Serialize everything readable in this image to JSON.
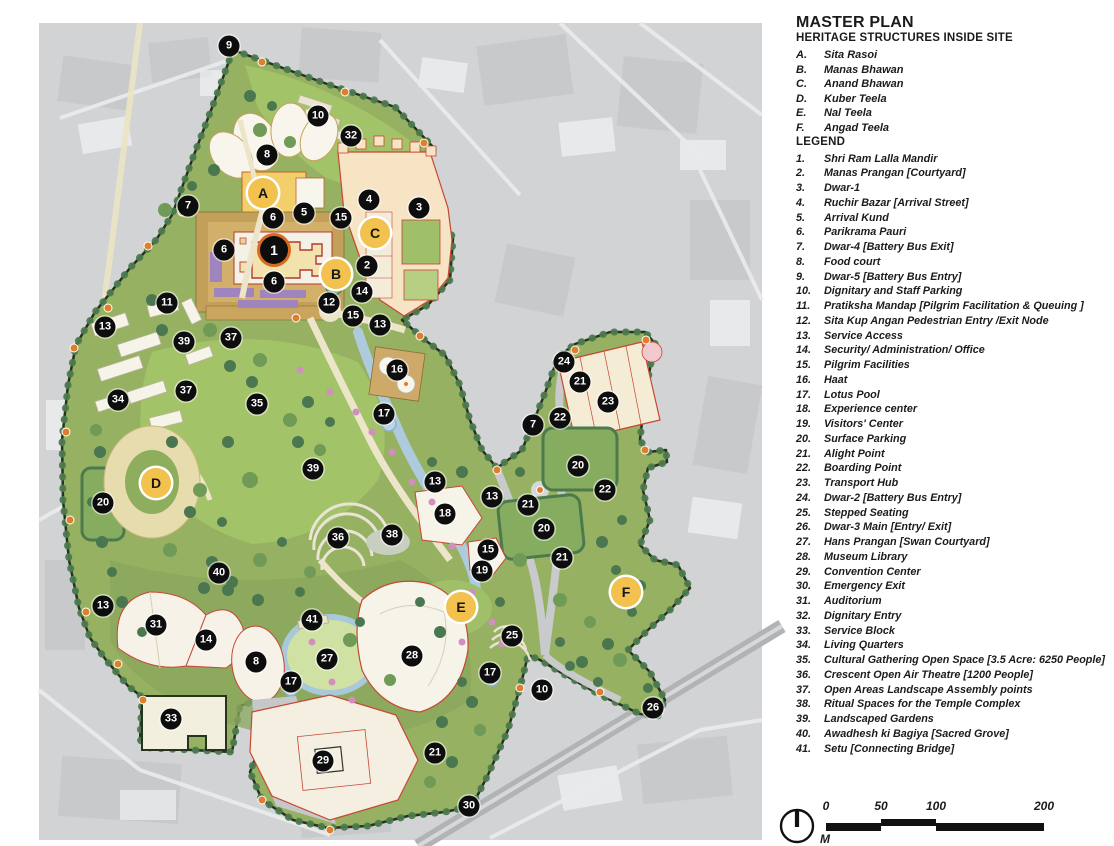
{
  "panel": {
    "title": "MASTER PLAN",
    "heritage": {
      "heading": "HERITAGE STRUCTURES INSIDE SITE",
      "items": [
        {
          "num": "A.",
          "label": "Sita Rasoi"
        },
        {
          "num": "B.",
          "label": "Manas Bhawan"
        },
        {
          "num": "C.",
          "label": "Anand Bhawan"
        },
        {
          "num": "D.",
          "label": "Kuber Teela"
        },
        {
          "num": "E.",
          "label": "Nal Teela"
        },
        {
          "num": "F.",
          "label": "Angad Teela"
        }
      ]
    },
    "legend": {
      "heading": "LEGEND",
      "items": [
        {
          "num": "1.",
          "label": "Shri Ram Lalla Mandir"
        },
        {
          "num": "2.",
          "label": "Manas Prangan [Courtyard]"
        },
        {
          "num": "3.",
          "label": "Dwar-1"
        },
        {
          "num": "4.",
          "label": "Ruchir Bazar [Arrival Street]"
        },
        {
          "num": "5.",
          "label": "Arrival Kund"
        },
        {
          "num": "6.",
          "label": "Parikrama Pauri"
        },
        {
          "num": "7.",
          "label": "Dwar-4 [Battery Bus Exit]"
        },
        {
          "num": "8.",
          "label": "Food court"
        },
        {
          "num": "9.",
          "label": "Dwar-5 [Battery Bus Entry]"
        },
        {
          "num": "10.",
          "label": "Dignitary and Staff Parking"
        },
        {
          "num": "11.",
          "label": "Pratiksha Mandap [Pilgrim Facilitation & Queuing ]"
        },
        {
          "num": "12.",
          "label": "Sita Kup Angan Pedestrian Entry /Exit Node"
        },
        {
          "num": "13.",
          "label": "Service Access"
        },
        {
          "num": "14.",
          "label": "Security/ Administration/ Office"
        },
        {
          "num": "15.",
          "label": "Pilgrim Facilities"
        },
        {
          "num": "16.",
          "label": "Haat"
        },
        {
          "num": "17.",
          "label": "Lotus Pool"
        },
        {
          "num": "18.",
          "label": "Experience center"
        },
        {
          "num": "19.",
          "label": "Visitors' Center"
        },
        {
          "num": "20.",
          "label": "Surface Parking"
        },
        {
          "num": "21.",
          "label": "Alight Point"
        },
        {
          "num": "22.",
          "label": "Boarding Point"
        },
        {
          "num": "23.",
          "label": "Transport Hub"
        },
        {
          "num": "24.",
          "label": "Dwar-2 [Battery Bus Entry]"
        },
        {
          "num": "25.",
          "label": "Stepped Seating"
        },
        {
          "num": "26.",
          "label": "Dwar-3 Main [Entry/ Exit]"
        },
        {
          "num": "27.",
          "label": "Hans Prangan [Swan Courtyard]"
        },
        {
          "num": "28.",
          "label": "Museum Library"
        },
        {
          "num": "29.",
          "label": "Convention Center"
        },
        {
          "num": "30.",
          "label": "Emergency Exit"
        },
        {
          "num": "31.",
          "label": "Auditorium"
        },
        {
          "num": "32.",
          "label": "Dignitary Entry"
        },
        {
          "num": "33.",
          "label": "Service Block"
        },
        {
          "num": "34.",
          "label": "Living Quarters"
        },
        {
          "num": "35.",
          "label": "Cultural Gathering Open Space [3.5 Acre: 6250 People]"
        },
        {
          "num": "36.",
          "label": "Crescent Open Air Theatre [1200 People]"
        },
        {
          "num": "37.",
          "label": "Open Areas Landscape Assembly points"
        },
        {
          "num": "38.",
          "label": "Ritual Spaces for the Temple Complex"
        },
        {
          "num": "39.",
          "label": "Landscaped Gardens"
        },
        {
          "num": "40.",
          "label": "Awadhesh ki Bagiya [Sacred Grove]"
        },
        {
          "num": "41.",
          "label": "Setu [Connecting Bridge]"
        }
      ]
    },
    "scale": {
      "ticks": [
        {
          "label": "0",
          "x": 0
        },
        {
          "label": "50",
          "x": 55
        },
        {
          "label": "100",
          "x": 110
        },
        {
          "label": "200",
          "x": 218
        }
      ],
      "unit": "M",
      "north_icon": "compass-north-arrow"
    }
  },
  "map": {
    "colors": {
      "marker_number_bg": "#0d0d0d",
      "marker_number_text": "#ffffff",
      "marker_letter_bg": "#f2c14e",
      "marker_letter_text": "#161616",
      "marker_1_ring": "#d86a1f",
      "site_green": "#96b161",
      "lawn_green": "#a3c368",
      "temple_tan": "#c9a55e",
      "building_cream": "#f6f2e7",
      "building_outline_red": "#c74634",
      "water_blue": "#aecbdd",
      "aerial_gray": "#d2d3d5",
      "entry_node_orange": "#df7e2b"
    },
    "markers": [
      {
        "label": "9",
        "x": 229,
        "y": 46
      },
      {
        "label": "10",
        "x": 318,
        "y": 116
      },
      {
        "label": "32",
        "x": 351,
        "y": 136
      },
      {
        "label": "8",
        "x": 267,
        "y": 155
      },
      {
        "label": "A",
        "x": 263,
        "y": 193,
        "kind": "letter"
      },
      {
        "label": "7",
        "x": 188,
        "y": 206
      },
      {
        "label": "4",
        "x": 369,
        "y": 200
      },
      {
        "label": "3",
        "x": 419,
        "y": 208
      },
      {
        "label": "5",
        "x": 304,
        "y": 213
      },
      {
        "label": "6",
        "x": 273,
        "y": 218
      },
      {
        "label": "15",
        "x": 341,
        "y": 218
      },
      {
        "label": "C",
        "x": 375,
        "y": 233,
        "kind": "letter"
      },
      {
        "label": "1",
        "x": 274,
        "y": 250,
        "big": true
      },
      {
        "label": "6",
        "x": 224,
        "y": 250
      },
      {
        "label": "2",
        "x": 367,
        "y": 266
      },
      {
        "label": "B",
        "x": 336,
        "y": 274,
        "kind": "letter"
      },
      {
        "label": "6",
        "x": 274,
        "y": 282
      },
      {
        "label": "14",
        "x": 362,
        "y": 292
      },
      {
        "label": "12",
        "x": 329,
        "y": 303
      },
      {
        "label": "11",
        "x": 167,
        "y": 303
      },
      {
        "label": "15",
        "x": 353,
        "y": 316
      },
      {
        "label": "13",
        "x": 380,
        "y": 325
      },
      {
        "label": "13",
        "x": 105,
        "y": 327
      },
      {
        "label": "37",
        "x": 231,
        "y": 338
      },
      {
        "label": "39",
        "x": 184,
        "y": 342
      },
      {
        "label": "24",
        "x": 564,
        "y": 362
      },
      {
        "label": "16",
        "x": 397,
        "y": 370
      },
      {
        "label": "21",
        "x": 580,
        "y": 382
      },
      {
        "label": "37",
        "x": 186,
        "y": 391
      },
      {
        "label": "34",
        "x": 118,
        "y": 400
      },
      {
        "label": "23",
        "x": 608,
        "y": 402
      },
      {
        "label": "35",
        "x": 257,
        "y": 404
      },
      {
        "label": "17",
        "x": 384,
        "y": 414
      },
      {
        "label": "22",
        "x": 560,
        "y": 418
      },
      {
        "label": "7",
        "x": 533,
        "y": 425
      },
      {
        "label": "20",
        "x": 578,
        "y": 466
      },
      {
        "label": "39",
        "x": 313,
        "y": 469
      },
      {
        "label": "13",
        "x": 435,
        "y": 482
      },
      {
        "label": "D",
        "x": 156,
        "y": 483,
        "kind": "letter"
      },
      {
        "label": "22",
        "x": 605,
        "y": 490
      },
      {
        "label": "13",
        "x": 492,
        "y": 497
      },
      {
        "label": "20",
        "x": 103,
        "y": 503
      },
      {
        "label": "21",
        "x": 528,
        "y": 505
      },
      {
        "label": "18",
        "x": 445,
        "y": 514
      },
      {
        "label": "20",
        "x": 544,
        "y": 529
      },
      {
        "label": "38",
        "x": 392,
        "y": 535
      },
      {
        "label": "36",
        "x": 338,
        "y": 538
      },
      {
        "label": "15",
        "x": 488,
        "y": 550
      },
      {
        "label": "21",
        "x": 562,
        "y": 558
      },
      {
        "label": "19",
        "x": 482,
        "y": 571
      },
      {
        "label": "40",
        "x": 219,
        "y": 573
      },
      {
        "label": "F",
        "x": 626,
        "y": 592,
        "kind": "letter"
      },
      {
        "label": "13",
        "x": 103,
        "y": 606
      },
      {
        "label": "E",
        "x": 461,
        "y": 607,
        "kind": "letter"
      },
      {
        "label": "41",
        "x": 312,
        "y": 620
      },
      {
        "label": "31",
        "x": 156,
        "y": 625
      },
      {
        "label": "25",
        "x": 512,
        "y": 636
      },
      {
        "label": "14",
        "x": 206,
        "y": 640
      },
      {
        "label": "28",
        "x": 412,
        "y": 656
      },
      {
        "label": "27",
        "x": 327,
        "y": 659
      },
      {
        "label": "8",
        "x": 256,
        "y": 662
      },
      {
        "label": "17",
        "x": 490,
        "y": 673
      },
      {
        "label": "17",
        "x": 291,
        "y": 682
      },
      {
        "label": "10",
        "x": 542,
        "y": 690
      },
      {
        "label": "26",
        "x": 653,
        "y": 708
      },
      {
        "label": "33",
        "x": 171,
        "y": 719
      },
      {
        "label": "21",
        "x": 435,
        "y": 753
      },
      {
        "label": "29",
        "x": 323,
        "y": 761
      },
      {
        "label": "30",
        "x": 469,
        "y": 806
      }
    ]
  }
}
